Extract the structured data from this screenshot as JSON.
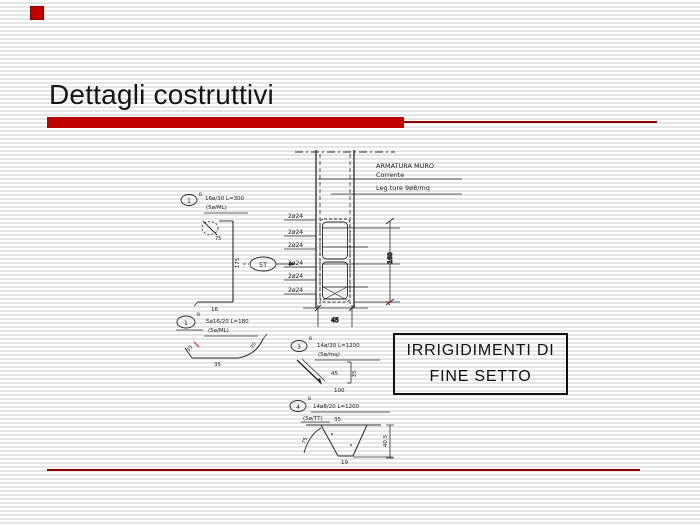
{
  "slide": {
    "title": "Dettagli costruttivi",
    "colors": {
      "accent_red": "#c00000",
      "rule_red": "#8e0000",
      "ink": "#1a1a1a",
      "stripe": "#e5e5e5"
    }
  },
  "label_box": {
    "line1": "IRRIGIDIMENTI DI",
    "line2": "FINE SETTO"
  },
  "drawing": {
    "wall_notes": {
      "title": "ARMATURA MURO",
      "sub": "Corrente",
      "ties": "Leg.ture 9ø8/mq"
    },
    "rebar_labels": [
      "2ø24",
      "2ø24",
      "2ø24",
      "2ø24",
      "2ø24",
      "2ø24"
    ],
    "marks": {
      "m1": "1",
      "m1_sup": "B",
      "m5t": "5T",
      "m2": "1",
      "m2_sup": "B",
      "m3": "3",
      "m3_sup": "B",
      "m4": "4",
      "m4_sup": "B"
    },
    "callouts": {
      "c1_line1": "16ø/30 L=300",
      "c1_line2": "(5ø/ML)",
      "c2_line1": "5ø16/20 L=180",
      "c2_line2": "(5ø/ML)",
      "c3_line1": "14ø/30 L=1200",
      "c3_line2": "(5ø/mq)",
      "c4_line1": "14ø8/20 L=1200",
      "c4_line2": "(5ø/TT)"
    },
    "dims": {
      "column_width": "45",
      "column_height": "160",
      "bar1_height": "175",
      "bar1_foot": "16",
      "bar1_hook": "75",
      "d2_left": "35",
      "d2_bottom": "35",
      "d2_arc": "70",
      "d3_diag": "45",
      "d3_right": "35",
      "d3_bottom": "100",
      "d4_top": "35",
      "d4_right": "40.5",
      "d4_arc": "75",
      "d4_bottom": "19"
    }
  }
}
